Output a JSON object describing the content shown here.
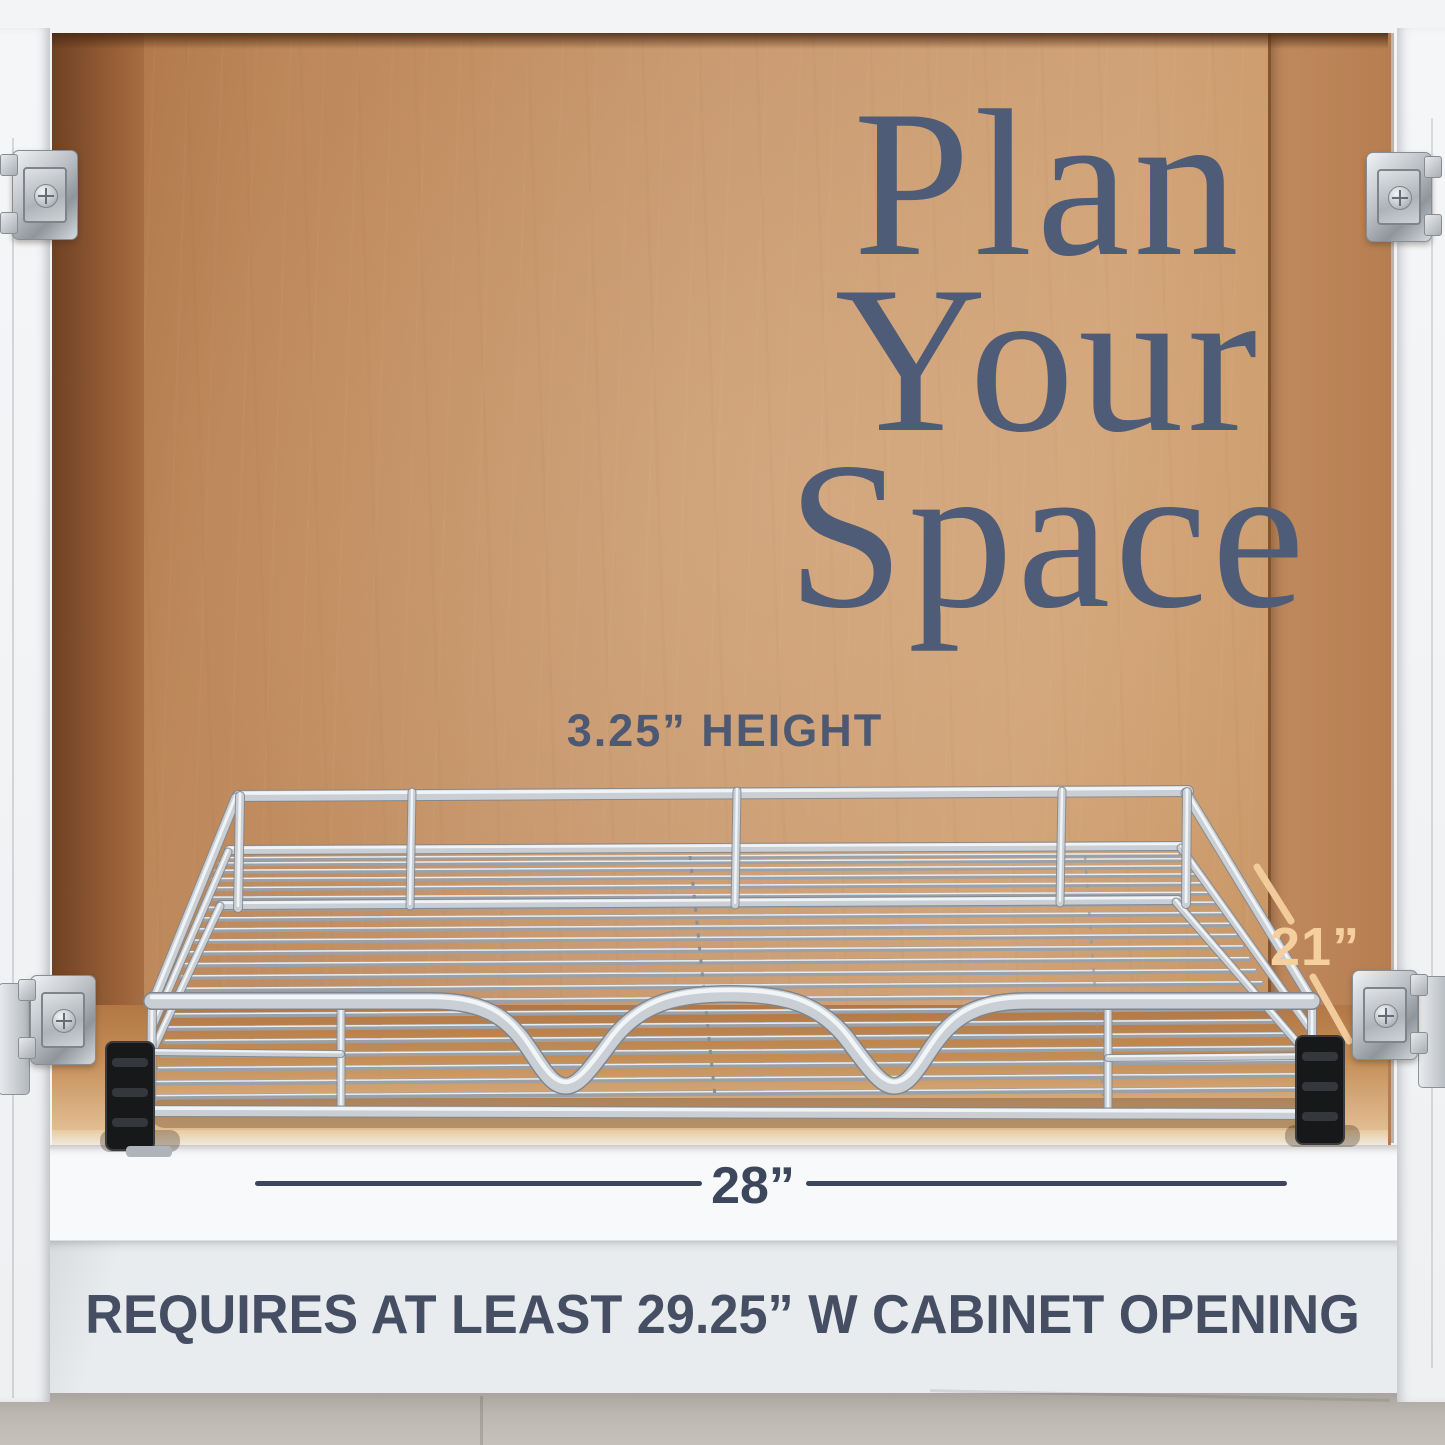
{
  "title_overlay": {
    "lines": [
      "Plan",
      "Your",
      "Space"
    ]
  },
  "labels": {
    "height": "3.25” HEIGHT",
    "depth": "21”",
    "width": "28”",
    "note": "REQUIRES AT LEAST 29.25” W CABINET OPENING"
  },
  "icons": {
    "hinge": "european-cabinet-hinge",
    "basket": "chrome-wire-pullout-basket"
  },
  "colors": {
    "headline_slate": "#4e5c78",
    "note_slate": "#454e63",
    "dimension_line": "#3d475c",
    "depth_peach": "#f5cfa0",
    "wood_back_wall": "#c99970",
    "wood_side_wall": "#8a5530",
    "cabinet_white": "#f3f4f6",
    "chrome": "#c6ccd2",
    "tile_floor_gray": "#bcb8b1"
  }
}
